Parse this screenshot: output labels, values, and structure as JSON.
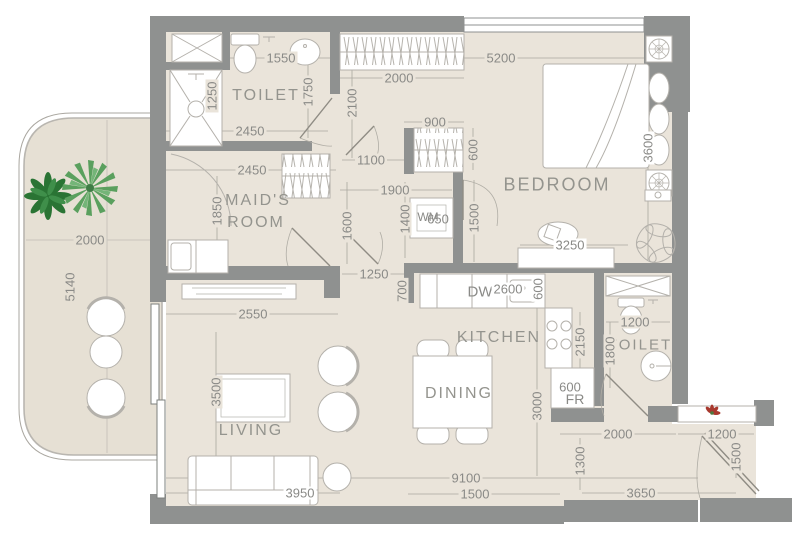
{
  "title": "apartment-floor-plan",
  "colors": {
    "wall": "#8f9190",
    "floor": "#eae4da",
    "balcony_floor": "#e6e0d4",
    "fixture_stroke": "#b4b1ab",
    "dim_text": "#8a8a87",
    "room_text": "#94948e",
    "plant_dark_green": "#2a7434",
    "plant_light_green": "#5aa05e",
    "accent_red": "#a8392e"
  },
  "rooms": [
    {
      "id": "toilet-top",
      "label": "TOILET"
    },
    {
      "id": "maids-room",
      "line1": "MAID'S",
      "line2": "ROOM"
    },
    {
      "id": "bedroom",
      "label": "BEDROOM"
    },
    {
      "id": "kitchen",
      "label": "KITCHEN"
    },
    {
      "id": "dining",
      "label": "DINING"
    },
    {
      "id": "living",
      "label": "LIVING"
    },
    {
      "id": "toilet-right",
      "label": "TOILET"
    }
  ],
  "appliances": [
    {
      "id": "dishwasher",
      "label": "DW"
    },
    {
      "id": "fridge",
      "label": "FR"
    },
    {
      "id": "washing-machine",
      "label": "WM"
    }
  ],
  "dims": [
    {
      "v": "1550"
    },
    {
      "v": "2000"
    },
    {
      "v": "5200"
    },
    {
      "v": "1250"
    },
    {
      "v": "1750"
    },
    {
      "v": "2100"
    },
    {
      "v": "2450"
    },
    {
      "v": "900"
    },
    {
      "v": "600"
    },
    {
      "v": "3600"
    },
    {
      "v": "2450"
    },
    {
      "v": "1100"
    },
    {
      "v": "1900"
    },
    {
      "v": "1850"
    },
    {
      "v": "1600"
    },
    {
      "v": "1400"
    },
    {
      "v": "650"
    },
    {
      "v": "1500"
    },
    {
      "v": "3250"
    },
    {
      "v": "1250"
    },
    {
      "v": "700"
    },
    {
      "v": "2600"
    },
    {
      "v": "600"
    },
    {
      "v": "2550"
    },
    {
      "v": "1200"
    },
    {
      "v": "2150"
    },
    {
      "v": "1800"
    },
    {
      "v": "3500"
    },
    {
      "v": "600"
    },
    {
      "v": "3000"
    },
    {
      "v": "2000"
    },
    {
      "v": "5140"
    },
    {
      "v": "2000"
    },
    {
      "v": "1200"
    },
    {
      "v": "1500"
    },
    {
      "v": "1300"
    },
    {
      "v": "9100"
    },
    {
      "v": "1500"
    },
    {
      "v": "3950"
    },
    {
      "v": "3650"
    }
  ]
}
